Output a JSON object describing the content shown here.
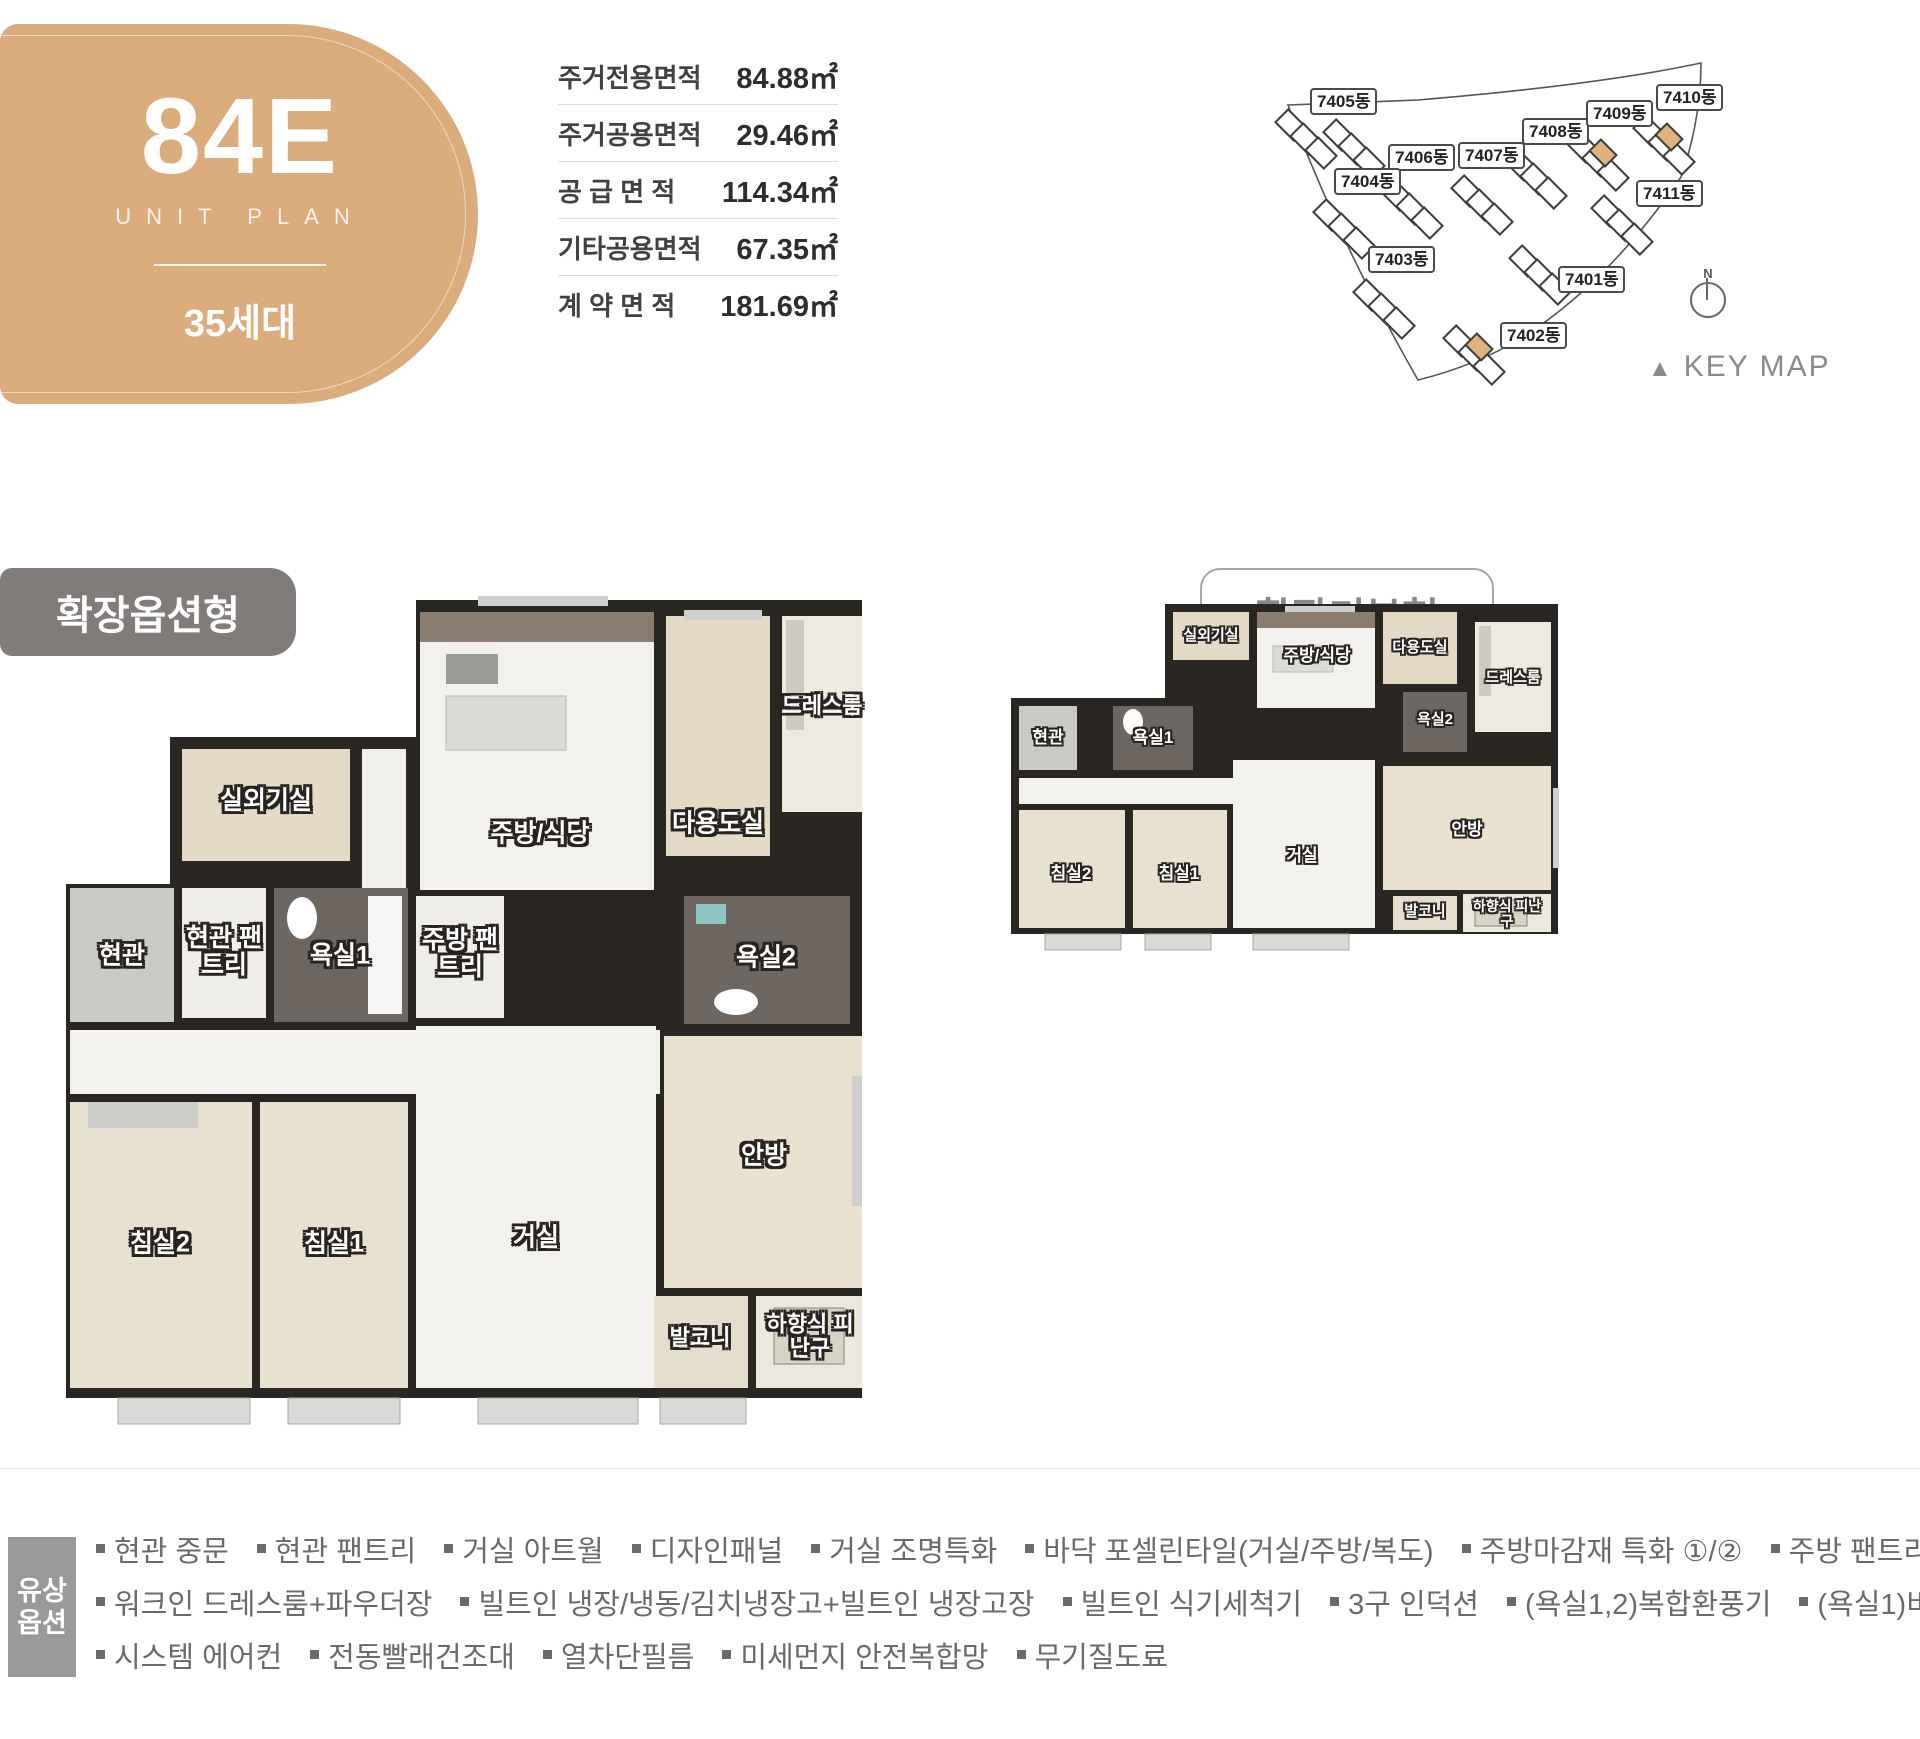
{
  "unit_badge": {
    "code": "84E",
    "subtitle": "UNIT PLAN",
    "households": "35세대"
  },
  "area_table": {
    "rows": [
      {
        "label": "주거전용면적",
        "value": "84.88㎡"
      },
      {
        "label": "주거공용면적",
        "value": "29.46㎡"
      },
      {
        "label": "공 급 면 적",
        "value": "114.34㎡"
      },
      {
        "label": "기타공용면적",
        "value": "67.35㎡"
      },
      {
        "label": "계 약 면 적",
        "value": "181.69㎡"
      }
    ]
  },
  "keymap": {
    "caption_marker": "▲",
    "caption": "KEY MAP",
    "compass_label": "N",
    "highlight_color": "#E0B27E",
    "buildings": [
      "7405동",
      "7406동",
      "7407동",
      "7408동",
      "7409동",
      "7410동",
      "7411동",
      "7404동",
      "7403동",
      "7401동",
      "7402동"
    ]
  },
  "plans": [
    {
      "title": "확장옵션형",
      "rooms": {
        "outdoor_unit": "실외기실",
        "kitchen": "주방/식당",
        "utility": "다용도실",
        "dress": "드레스룸",
        "kitchen_pantry": "주방 팬트리",
        "foyer": "현관",
        "foyer_pantry": "현관 팬트리",
        "bath1": "욕실1",
        "bath2": "욕실2",
        "master": "안방",
        "living": "거실",
        "bed1": "침실1",
        "bed2": "침실2",
        "balcony": "발코니",
        "escape": "하향식 피난구"
      }
    },
    {
      "title": "확장기본형",
      "rooms": {
        "outdoor_unit": "실외기실",
        "kitchen": "주방/식당",
        "utility": "다용도실",
        "dress": "드레스룸",
        "foyer": "현관",
        "bath1": "욕실1",
        "bath2": "욕실2",
        "master": "안방",
        "living": "거실",
        "bed1": "침실1",
        "bed2": "침실2",
        "balcony": "발코니",
        "escape": "하향식 피난구"
      }
    }
  ],
  "options": {
    "label_lines": [
      "유상",
      "옵션"
    ],
    "rows": [
      [
        "현관 중문",
        "현관 팬트리",
        "거실 아트월",
        "디자인패널",
        "거실 조명특화",
        "바닥 포셀린타일(거실/주방/복도)",
        "주방마감재 특화 ①/②",
        "주방 팬트리",
        "침실2 붙박이장"
      ],
      [
        "워크인 드레스룸+파우더장",
        "빌트인 냉장/냉동/김치냉장고+빌트인 냉장고장",
        "빌트인 식기세척기",
        "3구 인덕션",
        "(욕실1,2)복합환풍기",
        "(욕실1)비데",
        "드레스룸 제습기"
      ],
      [
        "시스템 에어컨",
        "전동빨래건조대",
        "열차단필름",
        "미세먼지 안전복합망",
        "무기질도료"
      ]
    ]
  }
}
